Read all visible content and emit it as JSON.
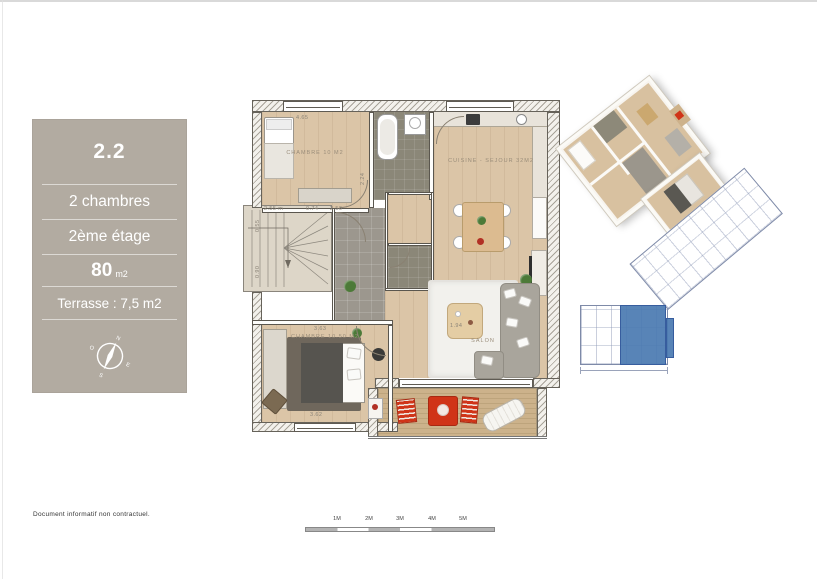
{
  "page": {
    "disclaimer": "Document informatif non contractuel.",
    "scale_labels": [
      "1M",
      "2M",
      "3M",
      "4M",
      "5M"
    ]
  },
  "info_panel": {
    "unit": "2.2",
    "rooms_line": "2 chambres",
    "floor_line": "2ème étage",
    "area_value": "80",
    "area_unit": "m2",
    "terrace_line": "Terrasse : 7,5 m2",
    "compass": {
      "north": "N",
      "east": "E",
      "south": "S",
      "west": "O"
    }
  },
  "floor_plan": {
    "rooms": [
      {
        "id": "chambre1",
        "label": "CHAMBRE 10 M2"
      },
      {
        "id": "cuisine_sejour",
        "label": "CUISINE - SEJOUR 32M2"
      },
      {
        "id": "chambre2",
        "label": "CHAMBRE 10.50 M2"
      },
      {
        "id": "salon",
        "label": "SALON"
      }
    ],
    "dimensions": {
      "chambre1_width": "4.65",
      "chambre1_depth": "2.24",
      "stair_width": "2.55 m",
      "stair_offset": "0.74",
      "hall_width": "2.50",
      "left_upper": "0.55",
      "left_lower": "0.90",
      "chambre2_width_top": "3.63",
      "chambre2_width_bottom": "3.62",
      "salon_table": "1.94"
    }
  },
  "colors": {
    "panel_taupe": "#b2aba1",
    "unit_highlight_blue": "#4a7ab1",
    "terrace_accent_red": "#d03418",
    "wood_floor": "#dbc5a7"
  }
}
